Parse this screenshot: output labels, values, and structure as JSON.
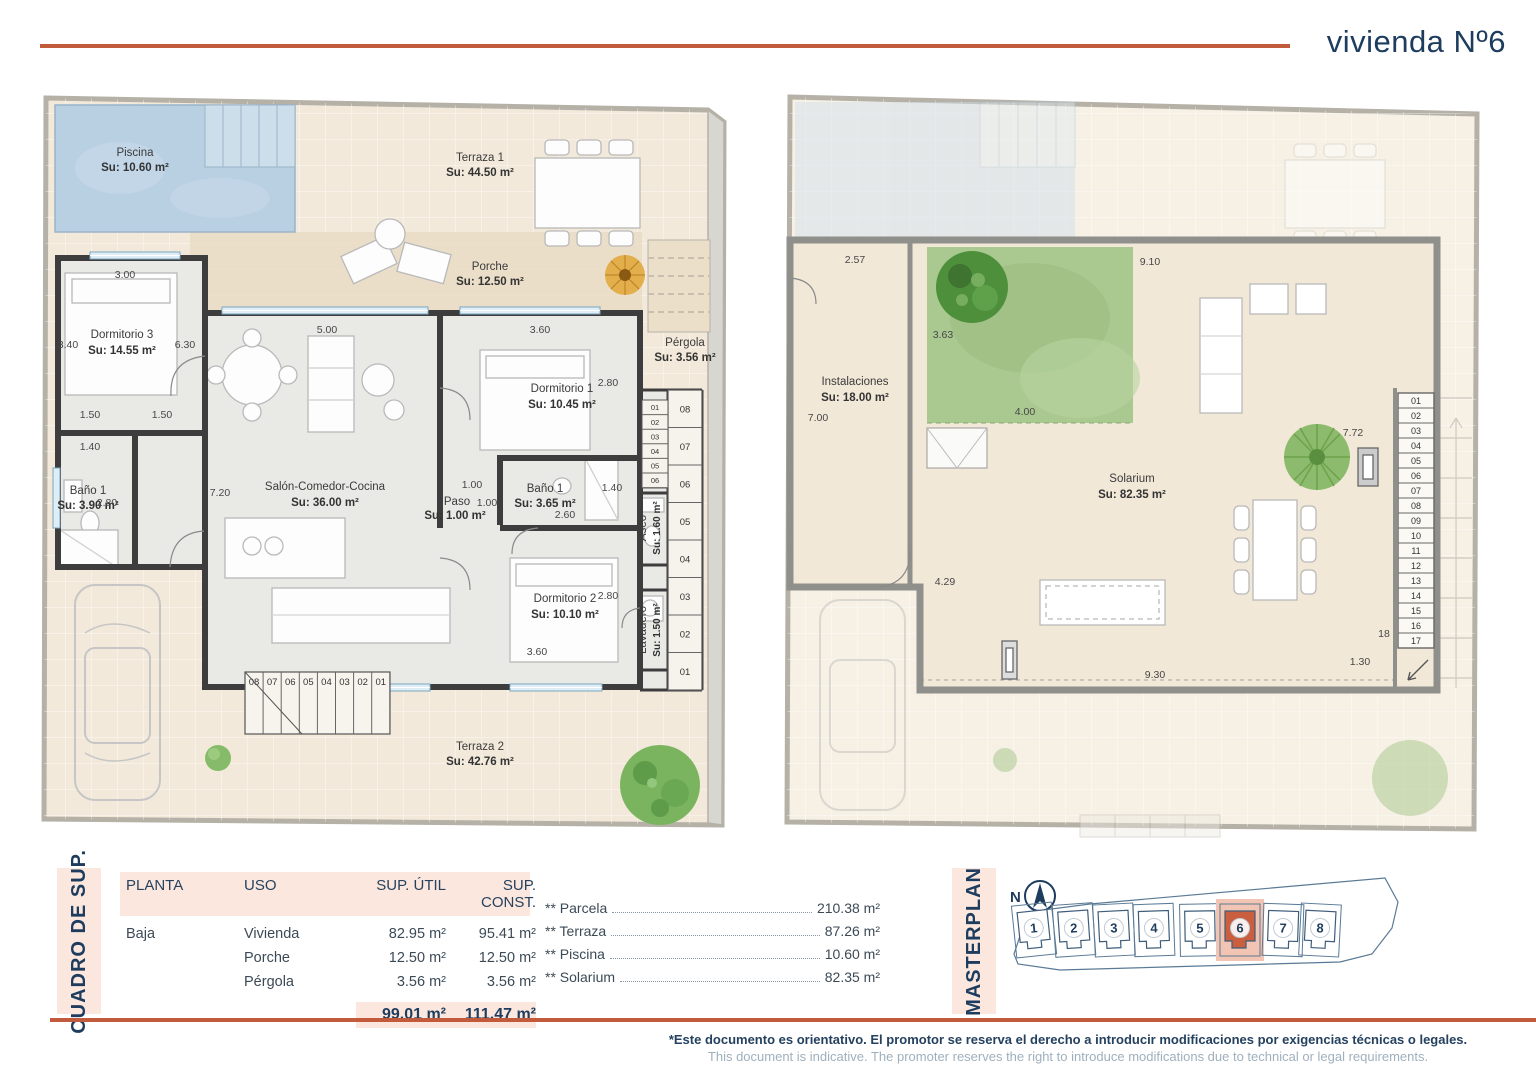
{
  "header": {
    "title": "vivienda Nº6"
  },
  "colors": {
    "accent": "#c25b3c",
    "navy": "#1d3c5e",
    "pink": "#fbe7dd",
    "highlight": "#c95f3e"
  },
  "plan_ground": {
    "rooms": {
      "piscina": {
        "name": "Piscina",
        "area": "Su: 10.60 m²"
      },
      "terraza1": {
        "name": "Terraza 1",
        "area": "Su: 44.50 m²"
      },
      "porche": {
        "name": "Porche",
        "area": "Su: 12.50 m²"
      },
      "pergola": {
        "name": "Pérgola",
        "area": "Su: 3.56 m²"
      },
      "dormitorio3": {
        "name": "Dormitorio 3",
        "area": "Su: 14.55 m²"
      },
      "bano1a": {
        "name": "Baño 1",
        "area": "Su: 3.90 m²"
      },
      "salon": {
        "name": "Salón-Comedor-Cocina",
        "area": "Su: 36.00 m²"
      },
      "dormitorio1": {
        "name": "Dormitorio 1",
        "area": "Su: 10.45 m²"
      },
      "bano1b": {
        "name": "Baño 1",
        "area": "Su: 3.65 m²"
      },
      "paso": {
        "name": "Paso",
        "area": "Su: 1.00 m²"
      },
      "dormitorio2": {
        "name": "Dormitorio 2",
        "area": "Su: 10.10 m²"
      },
      "aseo": {
        "name": "Aseo",
        "area": "Su: 1.60 m²"
      },
      "lavadero": {
        "name": "Lavadero",
        "area": "Su: 1.50 m²"
      },
      "terraza2": {
        "name": "Terraza 2",
        "area": "Su: 42.76 m²"
      }
    },
    "dims": [
      "3.00",
      "5.00",
      "3.60",
      "3.40",
      "6.30",
      "1.50",
      "1.50",
      "1.40",
      "2.80",
      "7.20",
      "1.00",
      "1.00",
      "2.60",
      "1.40",
      "2.80",
      "2.80",
      "3.60"
    ],
    "stairs_side": [
      "08",
      "07",
      "06",
      "05",
      "04",
      "03",
      "02",
      "01"
    ],
    "stairs_inner": [
      "01",
      "02",
      "03",
      "04",
      "05",
      "06"
    ],
    "stairs_bottom": [
      "08",
      "07",
      "06",
      "05",
      "04",
      "03",
      "02",
      "01"
    ]
  },
  "plan_roof": {
    "rooms": {
      "instalaciones": {
        "name": "Instalaciones",
        "area": "Su: 18.00 m²"
      },
      "solarium": {
        "name": "Solarium",
        "area": "Su: 82.35 m²"
      }
    },
    "dims": [
      "2.57",
      "9.10",
      "3.63",
      "4.00",
      "7.00",
      "7.72",
      "4.29",
      "9.30",
      "1.30",
      "18"
    ],
    "stairs": [
      "01",
      "02",
      "03",
      "04",
      "05",
      "06",
      "07",
      "08",
      "09",
      "10",
      "11",
      "12",
      "13",
      "14",
      "15",
      "16",
      "17"
    ]
  },
  "table": {
    "label": "CUADRO DE SUP.",
    "headers": [
      "PLANTA",
      "USO",
      "SUP. ÚTIL",
      "SUP. CONST."
    ],
    "rows": [
      {
        "planta": "Baja",
        "uso": "Vivienda",
        "util": "82.95 m²",
        "const": "95.41 m²"
      },
      {
        "planta": "",
        "uso": "Porche",
        "util": "12.50 m²",
        "const": "12.50 m²"
      },
      {
        "planta": "",
        "uso": "Pérgola",
        "util": "3.56 m²",
        "const": "3.56 m²"
      }
    ],
    "total_util": "99.01 m²",
    "total_const": "111.47 m²"
  },
  "summary": [
    {
      "label": "** Parcela",
      "value": "210.38 m²"
    },
    {
      "label": "** Terraza",
      "value": "87.26 m²"
    },
    {
      "label": "** Piscina",
      "value": "10.60 m²"
    },
    {
      "label": "** Solarium",
      "value": "82.35 m²"
    }
  ],
  "masterplan": {
    "label": "MASTERPLAN",
    "north": "N",
    "units": [
      "1",
      "2",
      "3",
      "4",
      "5",
      "6",
      "7",
      "8"
    ],
    "highlight": "6"
  },
  "footer": {
    "line1": "*Este documento es orientativo. El promotor se reserva el derecho a introducir modificaciones por exigencias técnicas o legales.",
    "line2": "This document is indicative. The promoter reserves the right to introduce modifications due to technical or legal requirements."
  }
}
